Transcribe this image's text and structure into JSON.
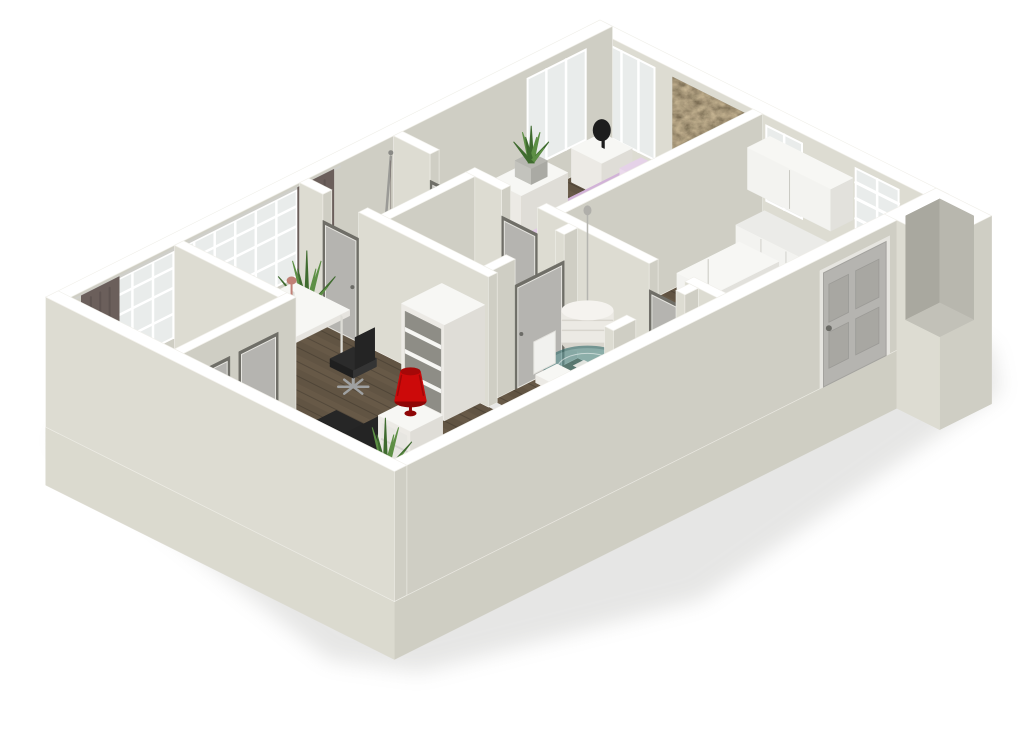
{
  "title": "3D floor plan render",
  "colors": {
    "background": "#ffffff",
    "shadow": "#8f8f8b",
    "wall_top": "#ffffff",
    "wall_top_edge": "#ededе8",
    "wall_sw": "#dddcd2",
    "wall_se": "#cfcec4",
    "wall_inner_a": "#a9a89f",
    "wall_inner_b": "#b8b7ae",
    "slab_se": "#cfcec3",
    "slab_sw": "#dbdacf",
    "floor_wood": "#675947",
    "floor_wood_line": "#3e372d",
    "floor_light": "#d6d5d0",
    "glass": "#e9eceb",
    "mullion": "#ffffff",
    "curtain": "#6b5f5b",
    "curtain_fold": "#564c49",
    "artwork": "#54432e",
    "bed": "#d2b3d8",
    "bed_side": "#c0a2c7",
    "bed_light": "#e5d2e8",
    "bed_frame": "#9b9b9b",
    "white_furn": "#f7f7f4",
    "white_furn_sw": "#eceae5",
    "white_furn_se": "#dfddd7",
    "door_leaf": "#b5b4b0",
    "door_frame": "#e6e5e0",
    "opening_dark": "#6f6e67",
    "cab_face": "#f3f3f0",
    "cab_side": "#e2e1dc",
    "counter_top": "#ebebe8",
    "sink": "#c6cacc",
    "black": "#232323",
    "chair_black": "#2b2b2b",
    "metal": "#9fa1a2",
    "pot": "#b7b7b1",
    "plant_green": "#5d8f45",
    "plant_dark": "#3f6b2f",
    "lamp_red": "#cc0a0a",
    "lamp_red_dark": "#8f0606",
    "lamp_pink": "#c08076",
    "pillow_mint": "#a8d4ae",
    "teal_glass": "#57908f",
    "teal_rim": "#2f6a6a",
    "pendant": "#eceae4",
    "pendant_dark": "#d8d5cd",
    "screen": "#dfe7ec",
    "fruit": "#e6a63c"
  },
  "scene": {
    "style": "isometric-3d-floorplan-render",
    "rooms": [
      "bedroom",
      "kitchen",
      "bathroom",
      "wc",
      "dining-nook",
      "entry-hall",
      "living-room",
      "closets"
    ],
    "items": [
      "lavender-double-bed",
      "nightstand",
      "black-table-lamp",
      "textured-wall-artwork",
      "plant-stand",
      "potted-plants",
      "three-pane-window",
      "kitchen-upper-cabinets",
      "kitchen-counter",
      "corner-sink",
      "tall-kitchen-cabinet",
      "fruit-bowl",
      "shelved-window",
      "shower-rail",
      "shower-curtain",
      "drum-pendant-lamp",
      "round-glass-dining-table",
      "white-dining-chairs",
      "white-desk",
      "open-laptop",
      "desk-lamp",
      "black-office-chair",
      "black-bench",
      "white-side-table",
      "red-table-lamp",
      "white-armchair",
      "mint-pillow",
      "open-shelf-unit",
      "white-step-dresser",
      "interior-doors",
      "front-door",
      "dark-curtains",
      "mullioned-window-wall",
      "utility-shaft"
    ]
  }
}
